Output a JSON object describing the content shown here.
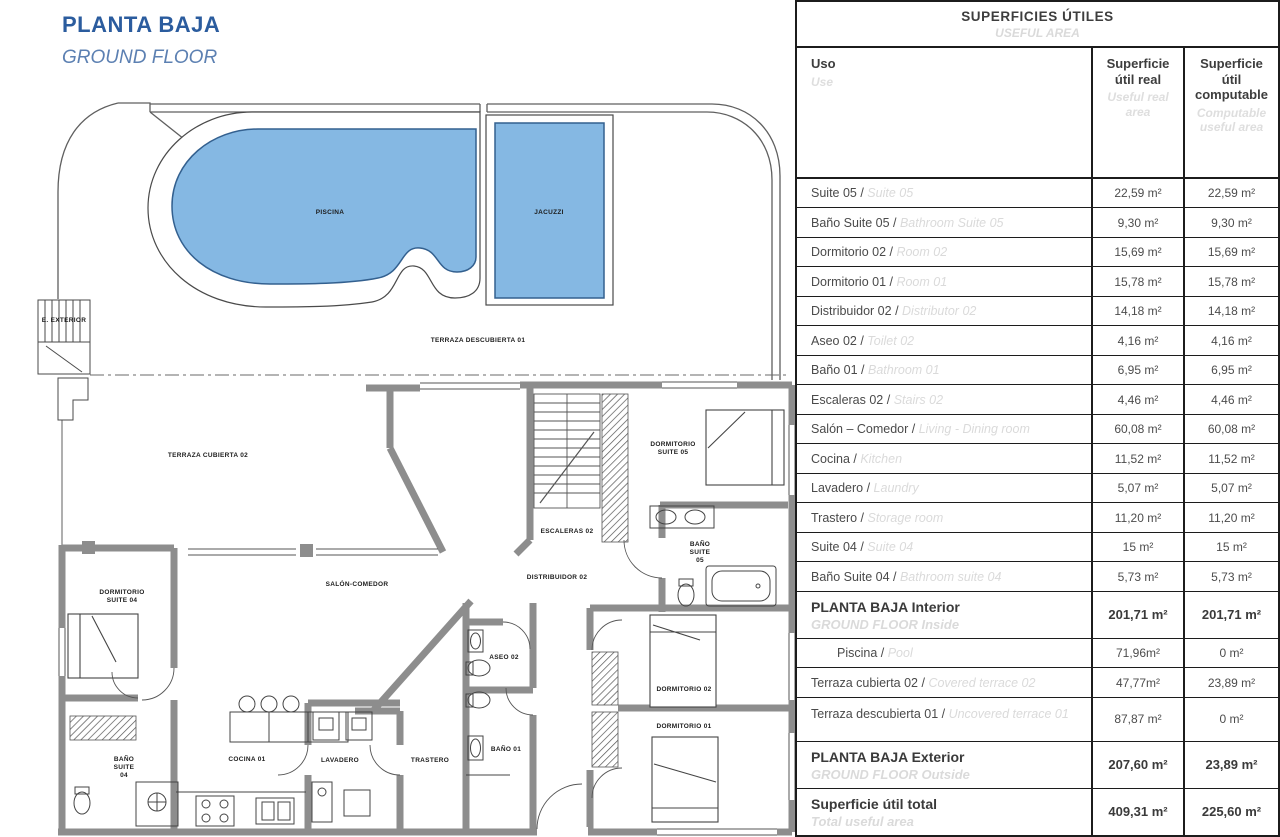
{
  "title": {
    "es": "PLANTA BAJA",
    "en": "GROUND FLOOR"
  },
  "colors": {
    "accent_blue": "#2b5c9e",
    "accent_blue_light": "#5c80b2",
    "pool_fill": "#85b8e3",
    "pool_stroke": "#33608f",
    "wall_gray": "#8d8d8d",
    "table_border": "#1c1c1c",
    "light_text": "#dadada"
  },
  "plan": {
    "labels": [
      {
        "text": "PISCINA",
        "x": 330,
        "y": 213
      },
      {
        "text": "JACUZZI",
        "x": 549,
        "y": 213
      },
      {
        "text": "TERRAZA DESCUBIERTA 01",
        "x": 478,
        "y": 341
      },
      {
        "text": "E. EXTERIOR",
        "x": 64,
        "y": 321
      },
      {
        "text": "TERRAZA CUBIERTA 02",
        "x": 208,
        "y": 456
      },
      {
        "text": "DORMITORIO\nSUITE 05",
        "x": 673,
        "y": 449
      },
      {
        "text": "ESCALERAS 02",
        "x": 567,
        "y": 532
      },
      {
        "text": "BAÑO\nSUITE\n05",
        "x": 700,
        "y": 553
      },
      {
        "text": "DISTRIBUIDOR 02",
        "x": 557,
        "y": 578
      },
      {
        "text": "SALÓN-COMEDOR",
        "x": 357,
        "y": 585
      },
      {
        "text": "DORMITORIO\nSUITE 04",
        "x": 122,
        "y": 597
      },
      {
        "text": "ASEO 02",
        "x": 504,
        "y": 658
      },
      {
        "text": "DORMITORIO 02",
        "x": 684,
        "y": 690
      },
      {
        "text": "DORMITORIO 01",
        "x": 684,
        "y": 727
      },
      {
        "text": "BAÑO\nSUITE\n04",
        "x": 124,
        "y": 768
      },
      {
        "text": "COCINA 01",
        "x": 247,
        "y": 760
      },
      {
        "text": "LAVADERO",
        "x": 340,
        "y": 761
      },
      {
        "text": "TRASTERO",
        "x": 430,
        "y": 761
      },
      {
        "text": "BAÑO 01",
        "x": 506,
        "y": 750
      }
    ]
  },
  "table": {
    "title": "SUPERFICIES ÚTILES",
    "title_en": "USEFUL AREA",
    "columns": {
      "uso": "Uso",
      "uso_en": "Use",
      "real": "Superficie útil real",
      "real_en": "Useful real area",
      "comp": "Superficie útil computable",
      "comp_en": "Computable useful area"
    },
    "rows": [
      {
        "uso": "Suite 05",
        "uso_en": "Suite 05",
        "real": "22,59 m²",
        "comp": "22,59 m²",
        "type": "item"
      },
      {
        "uso": "Baño Suite 05",
        "uso_en": "Bathroom Suite 05",
        "real": "9,30 m²",
        "comp": "9,30 m²",
        "type": "item"
      },
      {
        "uso": "Dormitorio 02",
        "uso_en": "Room 02",
        "real": "15,69 m²",
        "comp": "15,69 m²",
        "type": "item"
      },
      {
        "uso": "Dormitorio 01",
        "uso_en": "Room 01",
        "real": "15,78 m²",
        "comp": "15,78 m²",
        "type": "item"
      },
      {
        "uso": "Distribuidor 02",
        "uso_en": "Distributor 02",
        "real": "14,18 m²",
        "comp": "14,18 m²",
        "type": "item"
      },
      {
        "uso": "Aseo 02",
        "uso_en": "Toilet 02",
        "real": "4,16 m²",
        "comp": "4,16 m²",
        "type": "item"
      },
      {
        "uso": "Baño 01",
        "uso_en": "Bathroom 01",
        "real": "6,95 m²",
        "comp": "6,95 m²",
        "type": "item"
      },
      {
        "uso": "Escaleras 02",
        "uso_en": "Stairs 02",
        "real": "4,46 m²",
        "comp": "4,46 m²",
        "type": "item"
      },
      {
        "uso": "Salón – Comedor",
        "uso_en": "Living - Dining room",
        "real": "60,08 m²",
        "comp": "60,08 m²",
        "type": "item"
      },
      {
        "uso": "Cocina",
        "uso_en": "Kitchen",
        "real": "11,52 m²",
        "comp": "11,52 m²",
        "type": "item"
      },
      {
        "uso": "Lavadero",
        "uso_en": "Laundry",
        "real": "5,07 m²",
        "comp": "5,07 m²",
        "type": "item"
      },
      {
        "uso": "Trastero",
        "uso_en": "Storage room",
        "real": "11,20 m²",
        "comp": "11,20 m²",
        "type": "item"
      },
      {
        "uso": "Suite 04",
        "uso_en": "Suite 04",
        "real": "15 m²",
        "comp": "15 m²",
        "type": "item"
      },
      {
        "uso": "Baño Suite 04",
        "uso_en": "Bathroom suite 04",
        "real": "5,73 m²",
        "comp": "5,73 m²",
        "type": "item"
      },
      {
        "uso": "PLANTA BAJA Interior",
        "uso_en": "GROUND FLOOR Inside",
        "real": "201,71 m²",
        "comp": "201,71 m²",
        "type": "group"
      },
      {
        "uso": "Piscina",
        "uso_en": "Pool",
        "real": "71,96m²",
        "comp": "0 m²",
        "type": "sub"
      },
      {
        "uso": "Terraza cubierta 02",
        "uso_en": "Covered terrace 02",
        "real": "47,77m²",
        "comp": "23,89 m²",
        "type": "item"
      },
      {
        "uso": "Terraza descubierta 01",
        "uso_en": "Uncovered terrace 01",
        "real": "87,87 m²",
        "comp": "0 m²",
        "type": "item2"
      },
      {
        "uso": "PLANTA BAJA Exterior",
        "uso_en": "GROUND FLOOR Outside",
        "real": "207,60 m²",
        "comp": "23,89 m²",
        "type": "group"
      },
      {
        "uso": "Superficie útil total",
        "uso_en": "Total useful area",
        "real": "409,31 m²",
        "comp": "225,60 m²",
        "type": "total"
      }
    ]
  }
}
